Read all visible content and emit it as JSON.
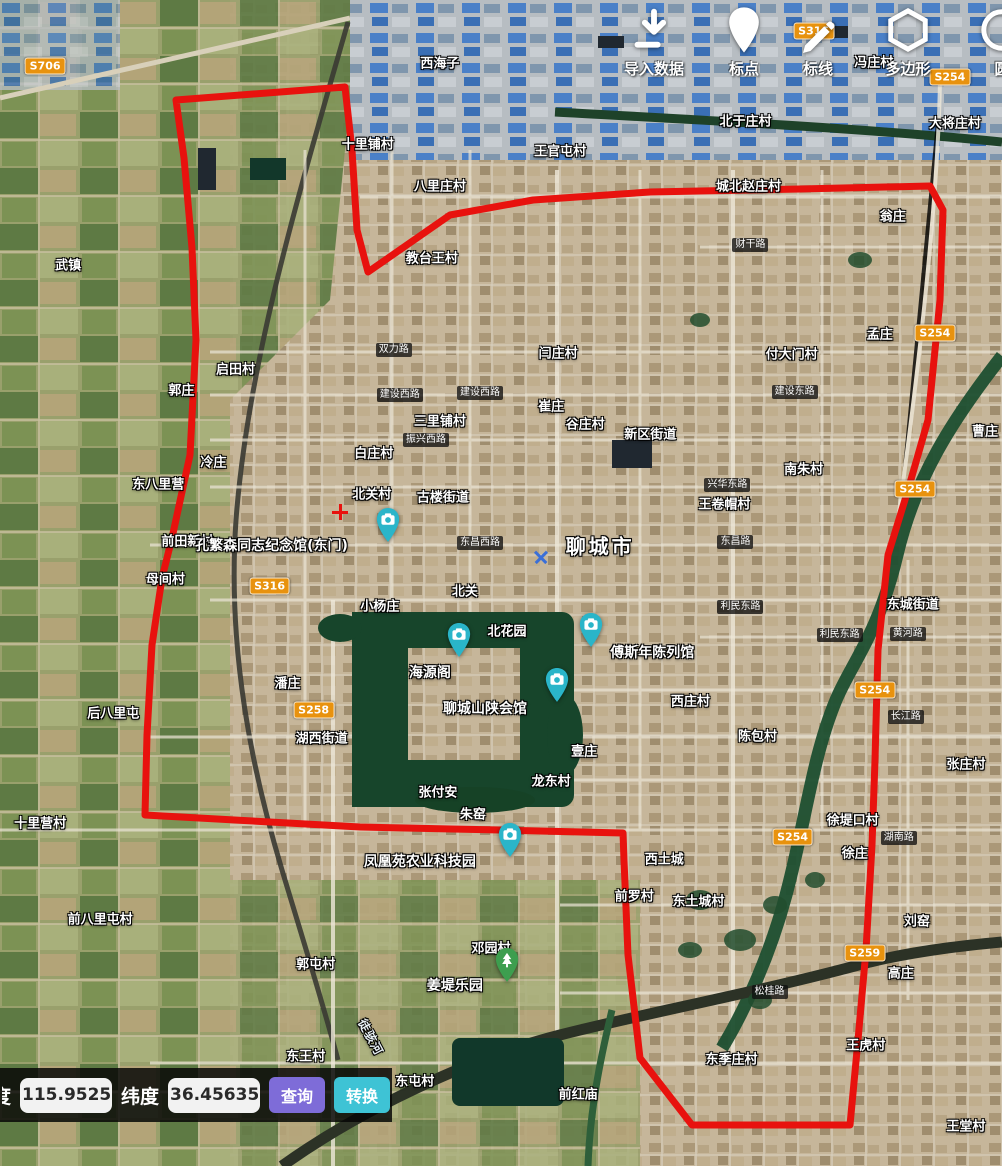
{
  "toolbar": {
    "items": [
      {
        "icon": "import-icon",
        "label": "导入数据"
      },
      {
        "icon": "pin-icon",
        "label": "标点"
      },
      {
        "icon": "pen-icon",
        "label": "标线"
      },
      {
        "icon": "hexagon-icon",
        "label": "多边形"
      },
      {
        "icon": "circle-icon",
        "label": "圆"
      }
    ]
  },
  "coord_bar": {
    "lon_label": "经度",
    "lon_value": "115.9525",
    "lat_label": "纬度",
    "lat_value": "36.45635",
    "query_label": "查询",
    "convert_label": "转换"
  },
  "colors": {
    "boundary": "#e8120e",
    "query_button": "#7e6cd8",
    "convert_button": "#3ec3d5",
    "camera_pin": "#2ab5c9",
    "park_pin": "#3d9e4f",
    "road_shield": "#e8920e"
  },
  "map": {
    "city_label": "聊城市",
    "labels": [
      {
        "text": "西海子",
        "x": 43.9,
        "y": 5.3,
        "kind": "place"
      },
      {
        "text": "冯庄村",
        "x": 87.2,
        "y": 5.2,
        "kind": "place"
      },
      {
        "text": "大将庄村",
        "x": 95.3,
        "y": 10.5,
        "kind": "place"
      },
      {
        "text": "北于庄村",
        "x": 74.4,
        "y": 10.3,
        "kind": "place"
      },
      {
        "text": "王官屯村",
        "x": 55.9,
        "y": 12.9,
        "kind": "place"
      },
      {
        "text": "城北赵庄村",
        "x": 74.7,
        "y": 15.9,
        "kind": "place"
      },
      {
        "text": "十里铺村",
        "x": 36.7,
        "y": 12.3,
        "kind": "place"
      },
      {
        "text": "八里庄村",
        "x": 43.9,
        "y": 15.9,
        "kind": "place"
      },
      {
        "text": "教台王村",
        "x": 43.1,
        "y": 22.0,
        "kind": "place"
      },
      {
        "text": "翁庄",
        "x": 89.1,
        "y": 18.4,
        "kind": "place"
      },
      {
        "text": "武镇",
        "x": 6.8,
        "y": 22.6,
        "kind": "place"
      },
      {
        "text": "孟庄",
        "x": 87.8,
        "y": 28.6,
        "kind": "place"
      },
      {
        "text": "付大门村",
        "x": 79.0,
        "y": 30.3,
        "kind": "place"
      },
      {
        "text": "闫庄村",
        "x": 55.7,
        "y": 30.2,
        "kind": "place"
      },
      {
        "text": "启田村",
        "x": 23.5,
        "y": 31.6,
        "kind": "place"
      },
      {
        "text": "郭庄",
        "x": 18.1,
        "y": 33.4,
        "kind": "place"
      },
      {
        "text": "三里铺村",
        "x": 43.9,
        "y": 36.0,
        "kind": "place"
      },
      {
        "text": "崔庄",
        "x": 55.0,
        "y": 34.7,
        "kind": "place"
      },
      {
        "text": "谷庄村",
        "x": 58.4,
        "y": 36.3,
        "kind": "place"
      },
      {
        "text": "新区街道",
        "x": 64.9,
        "y": 37.1,
        "kind": "place"
      },
      {
        "text": "白庄村",
        "x": 37.3,
        "y": 38.8,
        "kind": "place"
      },
      {
        "text": "冷庄",
        "x": 21.3,
        "y": 39.5,
        "kind": "place"
      },
      {
        "text": "东八里营",
        "x": 15.8,
        "y": 41.4,
        "kind": "place"
      },
      {
        "text": "南朱村",
        "x": 80.2,
        "y": 40.1,
        "kind": "place"
      },
      {
        "text": "王卷帽村",
        "x": 72.3,
        "y": 43.1,
        "kind": "place"
      },
      {
        "text": "北关村",
        "x": 37.1,
        "y": 42.3,
        "kind": "place"
      },
      {
        "text": "古楼街道",
        "x": 44.2,
        "y": 42.5,
        "kind": "place"
      },
      {
        "text": "曹庄",
        "x": 98.3,
        "y": 36.9,
        "kind": "place"
      },
      {
        "text": "前田新村",
        "x": 18.7,
        "y": 46.3,
        "kind": "place"
      },
      {
        "text": "母间村",
        "x": 16.5,
        "y": 49.6,
        "kind": "place"
      },
      {
        "text": "小杨庄",
        "x": 37.9,
        "y": 51.9,
        "kind": "place"
      },
      {
        "text": "北关",
        "x": 46.4,
        "y": 50.6,
        "kind": "place"
      },
      {
        "text": "东城街道",
        "x": 91.1,
        "y": 51.7,
        "kind": "place"
      },
      {
        "text": "北花园",
        "x": 50.6,
        "y": 54.0,
        "kind": "place"
      },
      {
        "text": "西庄村",
        "x": 68.9,
        "y": 60.0,
        "kind": "place"
      },
      {
        "text": "潘庄",
        "x": 28.7,
        "y": 58.5,
        "kind": "place"
      },
      {
        "text": "湖西街道",
        "x": 32.1,
        "y": 63.2,
        "kind": "place"
      },
      {
        "text": "后八里屯",
        "x": 11.3,
        "y": 61.1,
        "kind": "place"
      },
      {
        "text": "壹庄",
        "x": 58.3,
        "y": 64.3,
        "kind": "place"
      },
      {
        "text": "陈包村",
        "x": 75.6,
        "y": 63.0,
        "kind": "place"
      },
      {
        "text": "龙东村",
        "x": 55.0,
        "y": 66.9,
        "kind": "place"
      },
      {
        "text": "张付安",
        "x": 43.7,
        "y": 67.8,
        "kind": "place"
      },
      {
        "text": "朱窑",
        "x": 47.2,
        "y": 69.7,
        "kind": "place"
      },
      {
        "text": "张庄村",
        "x": 96.4,
        "y": 65.4,
        "kind": "place"
      },
      {
        "text": "徐堤口村",
        "x": 85.1,
        "y": 70.2,
        "kind": "place"
      },
      {
        "text": "十里营村",
        "x": 4.0,
        "y": 70.5,
        "kind": "place"
      },
      {
        "text": "西土城",
        "x": 66.3,
        "y": 73.6,
        "kind": "place"
      },
      {
        "text": "徐庄",
        "x": 85.3,
        "y": 73.1,
        "kind": "place"
      },
      {
        "text": "前罗村",
        "x": 63.3,
        "y": 76.8,
        "kind": "place"
      },
      {
        "text": "东土城村",
        "x": 69.7,
        "y": 77.2,
        "kind": "place"
      },
      {
        "text": "刘窑",
        "x": 91.5,
        "y": 78.9,
        "kind": "place"
      },
      {
        "text": "前八里屯村",
        "x": 10.0,
        "y": 78.7,
        "kind": "place"
      },
      {
        "text": "邓园村",
        "x": 49.0,
        "y": 81.2,
        "kind": "place"
      },
      {
        "text": "郭屯村",
        "x": 31.5,
        "y": 82.6,
        "kind": "place"
      },
      {
        "text": "高庄",
        "x": 89.9,
        "y": 83.4,
        "kind": "place"
      },
      {
        "text": "东王村",
        "x": 30.5,
        "y": 90.5,
        "kind": "place"
      },
      {
        "text": "东屯村",
        "x": 41.4,
        "y": 92.6,
        "kind": "place"
      },
      {
        "text": "东季庄村",
        "x": 73.0,
        "y": 90.7,
        "kind": "place"
      },
      {
        "text": "王虎村",
        "x": 86.4,
        "y": 89.5,
        "kind": "place"
      },
      {
        "text": "前红庙",
        "x": 57.7,
        "y": 93.7,
        "kind": "place"
      },
      {
        "text": "王堂村",
        "x": 96.4,
        "y": 96.5,
        "kind": "place"
      },
      {
        "text": "聊城市",
        "x": 59.9,
        "y": 46.7,
        "kind": "city"
      },
      {
        "text": "孔繁森同志纪念馆(东门)",
        "x": 27.1,
        "y": 46.7,
        "kind": "poi"
      },
      {
        "text": "海源阁",
        "x": 42.9,
        "y": 57.6,
        "kind": "poi"
      },
      {
        "text": "聊城山陕会馆",
        "x": 48.4,
        "y": 60.7,
        "kind": "poi"
      },
      {
        "text": "傅斯年陈列馆",
        "x": 65.1,
        "y": 55.9,
        "kind": "poi"
      },
      {
        "text": "凤凰苑农业科技园",
        "x": 41.9,
        "y": 73.8,
        "kind": "poi"
      },
      {
        "text": "姜堤乐园",
        "x": 45.4,
        "y": 84.5,
        "kind": "poi"
      },
      {
        "text": "徒骇河",
        "x": 37.0,
        "y": 88.9,
        "kind": "river"
      },
      {
        "text": "双力路",
        "x": 39.3,
        "y": 30.0,
        "kind": "road"
      },
      {
        "text": "财干路",
        "x": 74.9,
        "y": 21.0,
        "kind": "road"
      },
      {
        "text": "建设西路",
        "x": 39.9,
        "y": 33.9,
        "kind": "road"
      },
      {
        "text": "建设西路",
        "x": 47.9,
        "y": 33.7,
        "kind": "road"
      },
      {
        "text": "建设东路",
        "x": 79.3,
        "y": 33.6,
        "kind": "road"
      },
      {
        "text": "振兴西路",
        "x": 42.5,
        "y": 37.7,
        "kind": "road"
      },
      {
        "text": "兴华东路",
        "x": 72.6,
        "y": 41.6,
        "kind": "road"
      },
      {
        "text": "东昌西路",
        "x": 47.9,
        "y": 46.6,
        "kind": "road"
      },
      {
        "text": "东昌路",
        "x": 73.4,
        "y": 46.5,
        "kind": "road"
      },
      {
        "text": "利民东路",
        "x": 73.9,
        "y": 52.1,
        "kind": "road"
      },
      {
        "text": "利民东路",
        "x": 83.8,
        "y": 54.5,
        "kind": "road"
      },
      {
        "text": "黄河路",
        "x": 90.6,
        "y": 54.4,
        "kind": "road"
      },
      {
        "text": "长江路",
        "x": 90.4,
        "y": 61.5,
        "kind": "road"
      },
      {
        "text": "湖南路",
        "x": 89.7,
        "y": 71.9,
        "kind": "road"
      },
      {
        "text": "松桂路",
        "x": 76.8,
        "y": 85.1,
        "kind": "road"
      }
    ],
    "shields": [
      {
        "text": "S706",
        "x": 4.5,
        "y": 5.7
      },
      {
        "text": "S316",
        "x": 81.2,
        "y": 2.7
      },
      {
        "text": "S254",
        "x": 94.8,
        "y": 6.6
      },
      {
        "text": "S254",
        "x": 93.3,
        "y": 28.6
      },
      {
        "text": "S254",
        "x": 91.3,
        "y": 41.9
      },
      {
        "text": "S316",
        "x": 26.9,
        "y": 50.3
      },
      {
        "text": "S254",
        "x": 87.3,
        "y": 59.2
      },
      {
        "text": "S258",
        "x": 31.3,
        "y": 60.9
      },
      {
        "text": "S254",
        "x": 79.1,
        "y": 71.8
      },
      {
        "text": "S259",
        "x": 86.3,
        "y": 81.7
      }
    ],
    "pois": [
      {
        "name": "孔繁森同志纪念馆(东门)",
        "type": "camera",
        "x": 38.7,
        "y": 46.6
      },
      {
        "name": "海源阁",
        "type": "camera",
        "x": 45.8,
        "y": 56.4
      },
      {
        "name": "傅斯年陈列馆",
        "type": "camera",
        "x": 59.0,
        "y": 55.6
      },
      {
        "name": "聊城山陕会馆",
        "type": "camera",
        "x": 55.6,
        "y": 60.3
      },
      {
        "name": "凤凰苑农业科技园",
        "type": "camera",
        "x": 50.9,
        "y": 73.6
      },
      {
        "name": "姜堤乐园",
        "type": "park",
        "x": 50.6,
        "y": 84.3
      }
    ],
    "polygon": [
      [
        176,
        100
      ],
      [
        345,
        87
      ],
      [
        352,
        150
      ],
      [
        357,
        230
      ],
      [
        368,
        272
      ],
      [
        450,
        215
      ],
      [
        533,
        200
      ],
      [
        650,
        192
      ],
      [
        800,
        189
      ],
      [
        930,
        186
      ],
      [
        943,
        210
      ],
      [
        940,
        300
      ],
      [
        928,
        420
      ],
      [
        908,
        490
      ],
      [
        888,
        555
      ],
      [
        878,
        650
      ],
      [
        875,
        760
      ],
      [
        872,
        845
      ],
      [
        866,
        950
      ],
      [
        858,
        1040
      ],
      [
        850,
        1125
      ],
      [
        692,
        1125
      ],
      [
        640,
        1058
      ],
      [
        628,
        955
      ],
      [
        624,
        860
      ],
      [
        623,
        833
      ],
      [
        500,
        830
      ],
      [
        360,
        827
      ],
      [
        145,
        815
      ],
      [
        147,
        735
      ],
      [
        152,
        645
      ],
      [
        162,
        578
      ],
      [
        172,
        538
      ],
      [
        190,
        455
      ],
      [
        196,
        340
      ],
      [
        192,
        248
      ],
      [
        184,
        158
      ]
    ]
  }
}
